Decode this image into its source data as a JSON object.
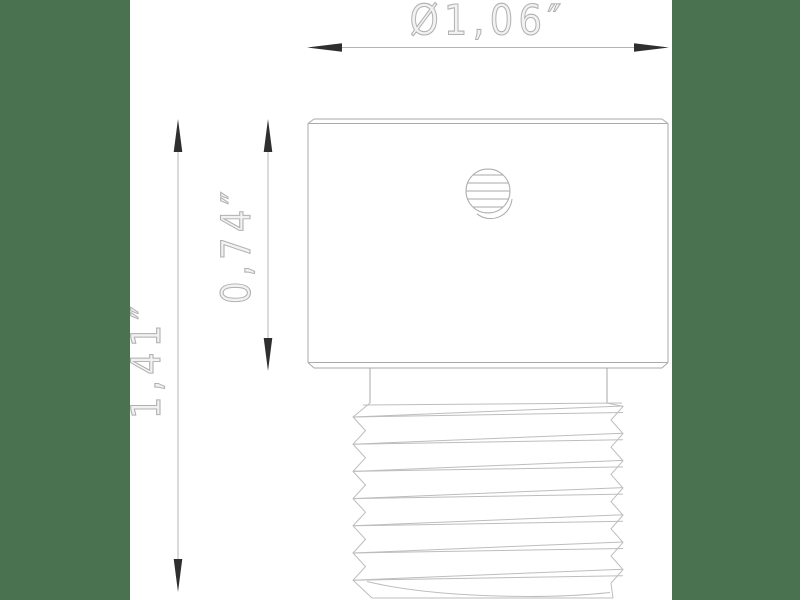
{
  "drawing": {
    "type": "technical-dimension-drawing",
    "part": "threaded-plug-side-view",
    "dimensions": {
      "diameter_label": "Ø1,06″",
      "body_height_label": "0,74″",
      "total_height_label": "1,41″"
    }
  },
  "colors": {
    "backdrop": "#4a7150",
    "canvas": "#ffffff",
    "dim_line": "#b4b4b4",
    "part_line": "#aaaaaa",
    "thread_line": "#bdbdbd",
    "arrow": "#2f2f2f",
    "label": "#b0b0b0"
  }
}
